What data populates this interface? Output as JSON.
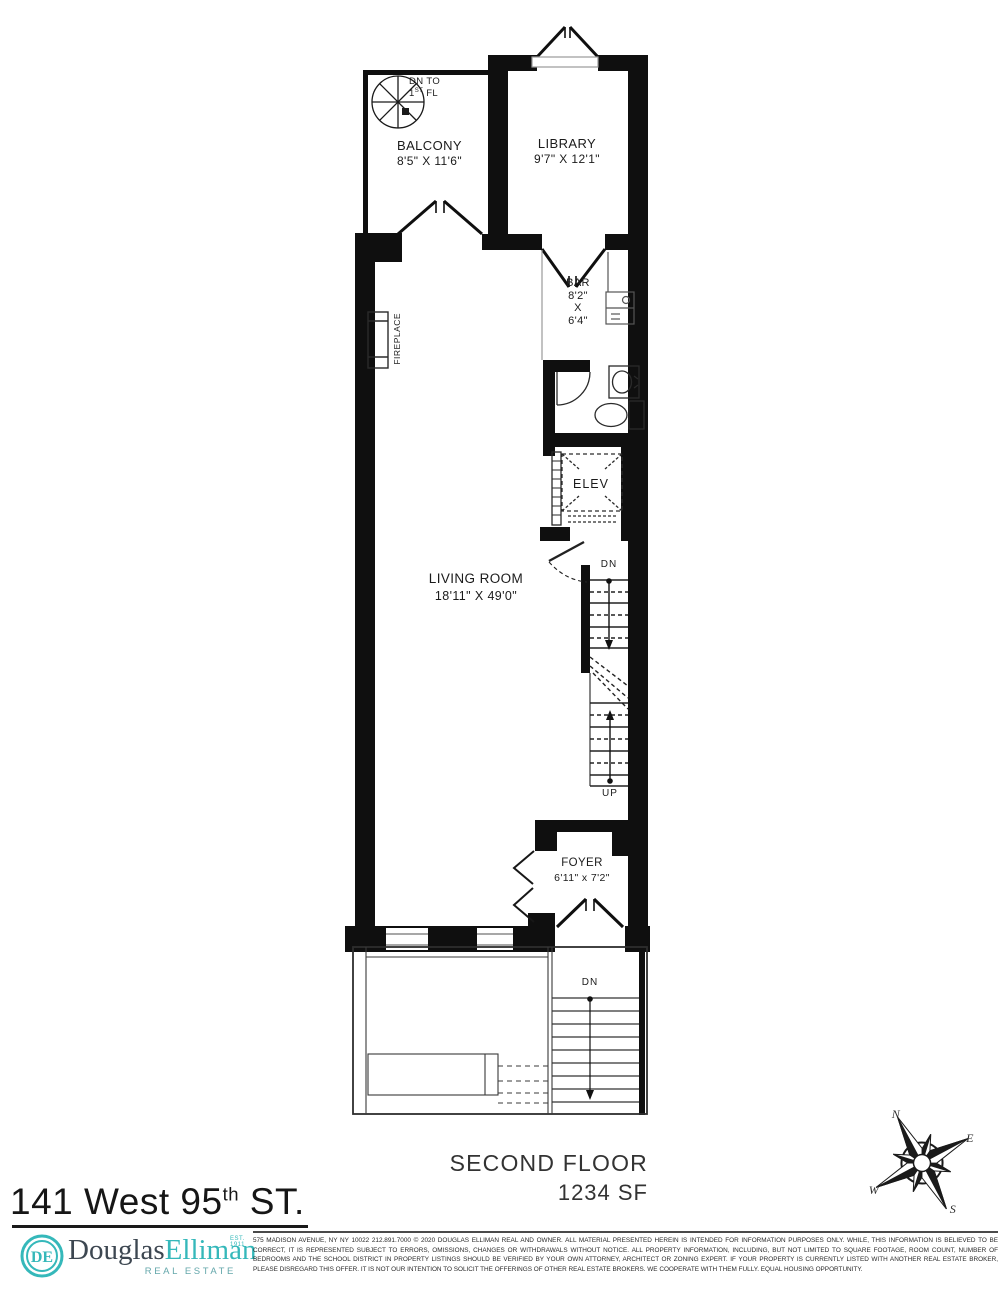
{
  "plan": {
    "balcony": {
      "name": "BALCONY",
      "dims": "8'5\" X 11'6\""
    },
    "library": {
      "name": "LIBRARY",
      "dims": "9'7\" X 12'1\""
    },
    "bar": {
      "name": "BAR",
      "width": "8'2\"",
      "by": "X",
      "depth": "6'4\""
    },
    "living_room": {
      "name": "LIVING ROOM",
      "dims": "18'11\" X 49'0\""
    },
    "foyer": {
      "name": "FOYER",
      "dims": "6'11\" x 7'2\""
    },
    "elevator": {
      "name": "ELEV"
    },
    "fireplace": {
      "name": "FIREPLACE"
    },
    "spiral_stair": {
      "line1": "DN TO",
      "num": "1",
      "sup": "ST",
      "rest": " FL"
    },
    "stair_down": "DN",
    "stair_up": "UP",
    "exterior_stair_down": "DN"
  },
  "compass": {
    "n": "N",
    "e": "E",
    "w": "W",
    "s": "S"
  },
  "footer": {
    "floor_label": "SECOND FLOOR",
    "floor_area": "1234 SF"
  },
  "title": {
    "main": "141 West 95",
    "sup": "th",
    "rest": " ST."
  },
  "brand": {
    "monogram": "DE",
    "name_first": "Douglas",
    "name_last": "Elliman",
    "est": "EST. 1911",
    "tagline": "REAL ESTATE",
    "accent_color": "#35b8ba",
    "ink_color": "#3d4751"
  },
  "disclaimer": "575 MADISON AVENUE, NY NY 10022 212.891.7000 © 2020 DOUGLAS ELLIMAN REAL AND OWNER. ALL MATERIAL PRESENTED HEREIN IS INTENDED FOR INFORMATION PURPOSES ONLY. WHILE, THIS INFORMATION IS BELIEVED TO BE CORRECT, IT IS REPRESENTED SUBJECT TO ERRORS, OMISSIONS, CHANGES OR WITHDRAWALS WITHOUT NOTICE. ALL PROPERTY INFORMATION, INCLUDING, BUT NOT LIMITED TO SQUARE FOOTAGE, ROOM COUNT, NUMBER OF BEDROOMS AND THE SCHOOL DISTRICT IN PROPERTY LISTINGS SHOULD BE VERIFIED BY YOUR OWN ATTORNEY, ARCHITECT OR ZONING EXPERT. IF YOUR PROPERTY IS CURRENTLY LISTED WITH ANOTHER REAL ESTATE BROKER, PLEASE DISREGARD THIS OFFER. IT IS NOT OUR INTENTION TO SOLICIT THE OFFERINGS OF OTHER REAL ESTATE BROKERS. WE COOPERATE WITH THEM FULLY. EQUAL HOUSING OPPORTUNITY."
}
